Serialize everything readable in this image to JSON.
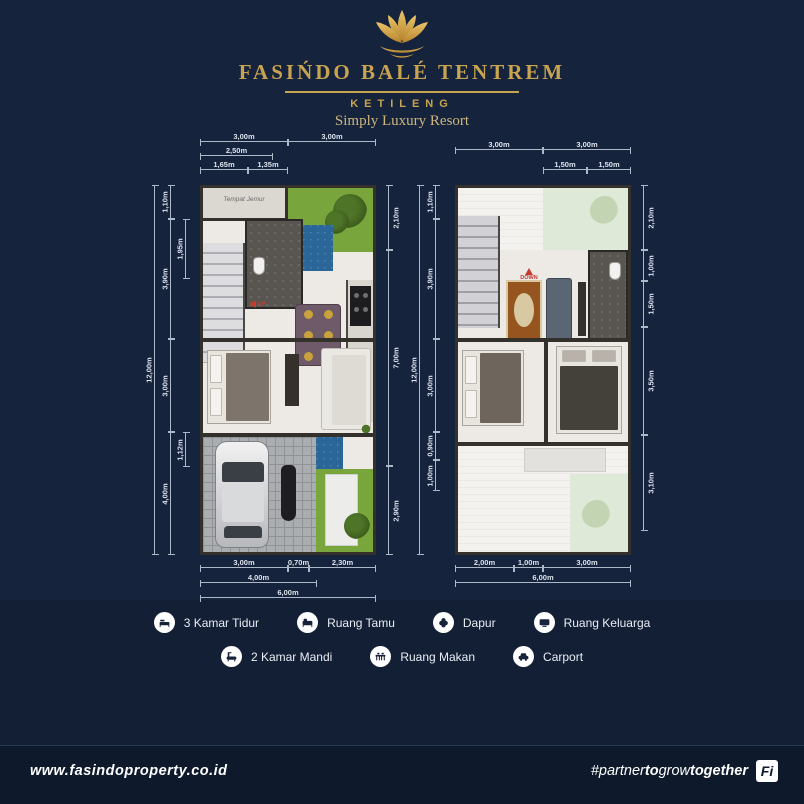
{
  "header": {
    "brand": "FASIŃDO BALÉ TENTREM",
    "location": "KETILENG",
    "tagline": "Simply Luxury Resort"
  },
  "plans": [
    {
      "name": "ground-floor",
      "room_labels": {
        "laundry": "Tempat Jemur",
        "stair": "UP"
      },
      "dims": {
        "top_row1": [
          "3,00m",
          "3,00m"
        ],
        "top_row2": [
          "2,50m"
        ],
        "top_row3": [
          "1,65m",
          "1,35m"
        ],
        "left_outer": "12,00m",
        "left_chain": [
          "1,10m",
          "3,90m",
          "3,00m",
          "4,00m"
        ],
        "left_inner": [
          "1,95m",
          "1,12m"
        ],
        "right_chain": [
          "2,10m",
          "7,00m",
          "2,90m"
        ],
        "bottom_row1": [
          "3,00m",
          "0,70m",
          "2,30m"
        ],
        "bottom_row2": [
          "4,00m"
        ],
        "bottom_row3": [
          "6,00m"
        ]
      }
    },
    {
      "name": "upper-floor",
      "room_labels": {
        "stair": "DOWN"
      },
      "dims": {
        "top_row1": [
          "3,00m",
          "3,00m"
        ],
        "top_row2": [
          "1,50m",
          "1,50m"
        ],
        "left_outer": "12,00m",
        "left_chain": [
          "1,10m",
          "3,90m",
          "3,00m",
          "0,90m",
          "1,00m"
        ],
        "right_chain": [
          "2,10m",
          "1,00m",
          "1,50m",
          "3,50m",
          "3,10m"
        ],
        "bottom_row1": [
          "2,00m",
          "1,00m",
          "3,00m"
        ],
        "bottom_row2": [
          "6,00m"
        ]
      }
    }
  ],
  "legend": {
    "row1": [
      {
        "icon": "bed-icon",
        "label": "3 Kamar Tidur"
      },
      {
        "icon": "sofa-icon",
        "label": "Ruang Tamu"
      },
      {
        "icon": "kitchen-icon",
        "label": "Dapur"
      },
      {
        "icon": "tv-icon",
        "label": "Ruang Keluarga"
      }
    ],
    "row2": [
      {
        "icon": "bathtub-icon",
        "label": "2 Kamar Mandi"
      },
      {
        "icon": "dining-icon",
        "label": "Ruang Makan"
      },
      {
        "icon": "car-icon",
        "label": "Carport"
      }
    ]
  },
  "footer": {
    "website": "www.fasindoproperty.co.id",
    "hashtag_parts": [
      "#partner",
      "to",
      "grow",
      "together"
    ],
    "logo_mark": "Fi"
  },
  "colors": {
    "background": "#16233C",
    "gold": "#C8A350",
    "marker_red": "#C43B2F",
    "garden_green": "#79A63C",
    "pool_blue": "#2B6699"
  }
}
